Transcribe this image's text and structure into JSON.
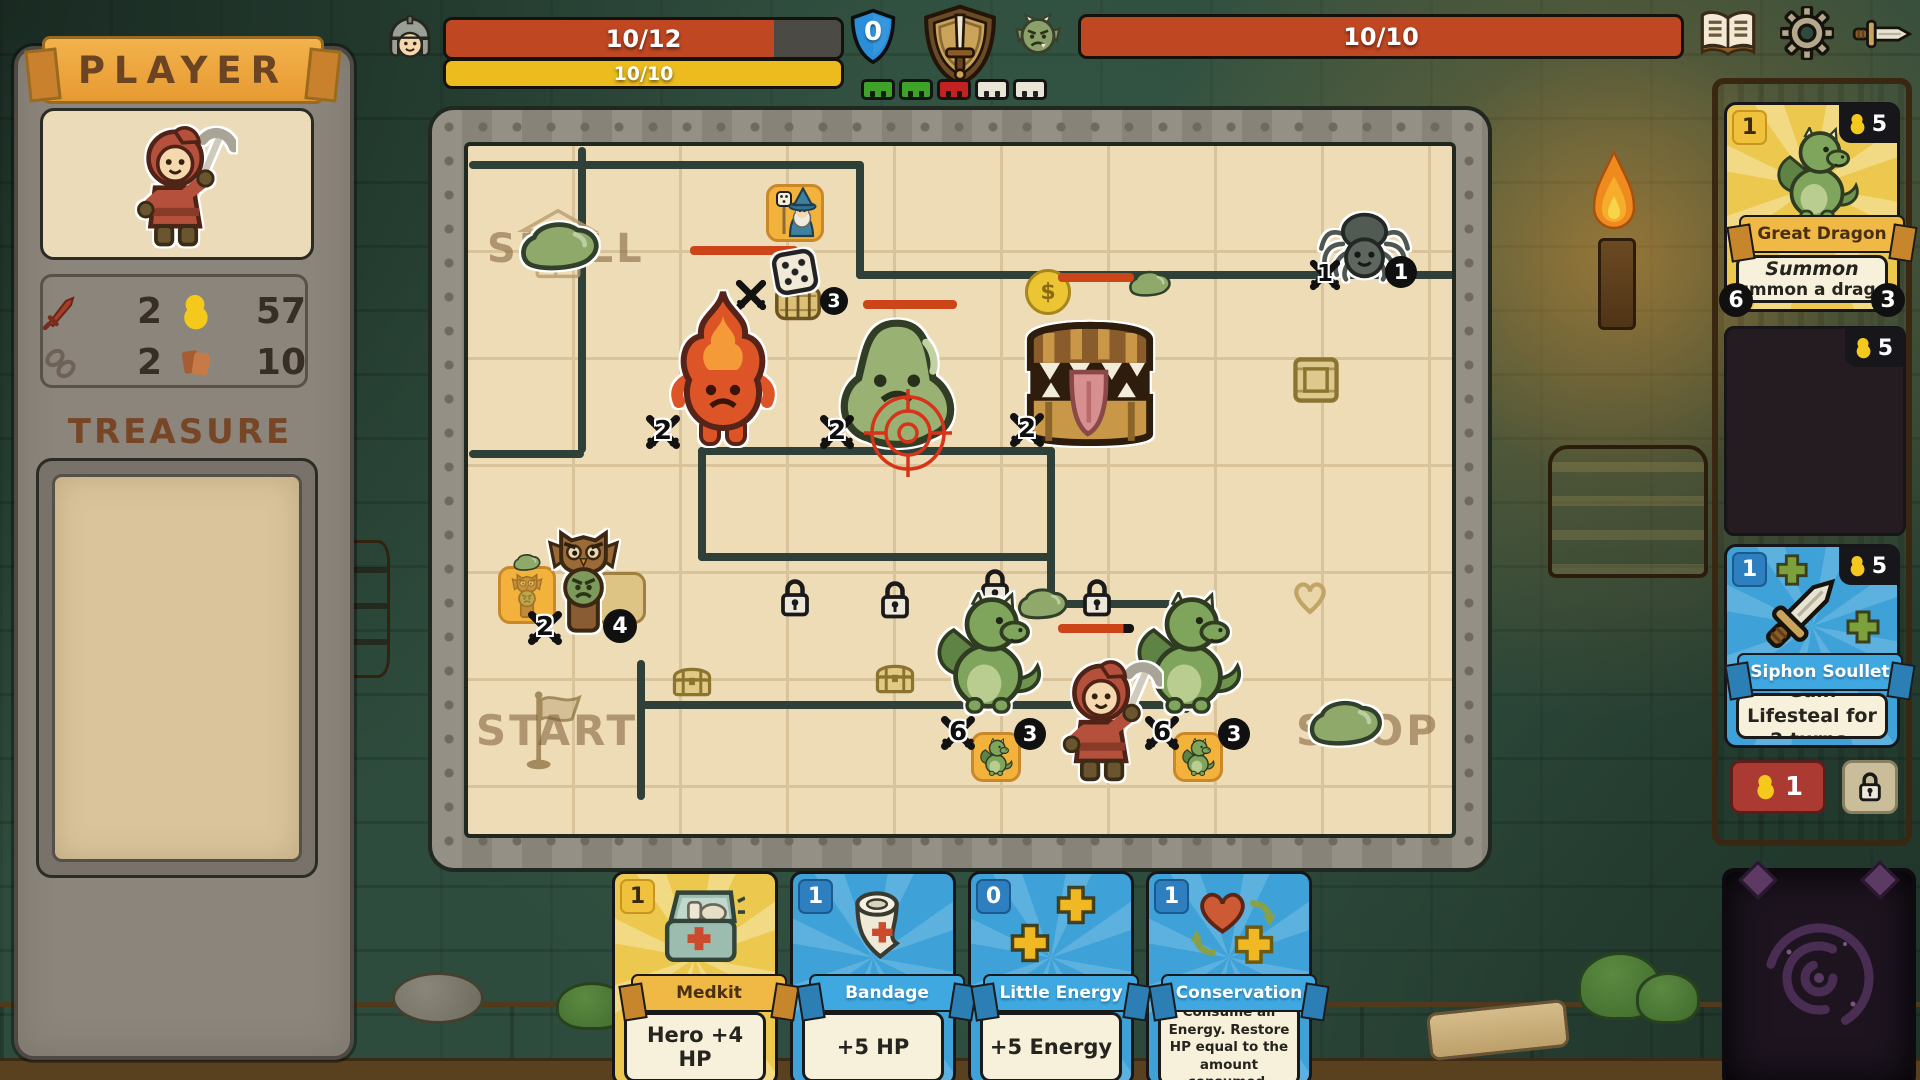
{
  "top": {
    "player_hp": "10/12",
    "player_energy": "10/10",
    "block": "0",
    "enemy_hp": "10/10",
    "turn_segments": [
      "green",
      "green",
      "red",
      "empty",
      "empty"
    ]
  },
  "left": {
    "title": "PLAYER",
    "stats": {
      "attack": "2",
      "gold": "57",
      "chain": "2",
      "cards": "10"
    },
    "treasure_title": "TREASURE"
  },
  "board": {
    "skull_label": "SKULL",
    "start_label": "START",
    "shop_label": "SHOP",
    "barrel_count": "3",
    "fire_atk": "2",
    "slime_atk": "2",
    "mimic_atk": "2",
    "mimic_coin": "$",
    "spider_atk": "1",
    "spider_count": "1",
    "totem_atk": "2",
    "totem_count": "4",
    "dragon_left_atk": "6",
    "dragon_left_count": "3",
    "dragon_right_atk": "6",
    "dragon_right_count": "3"
  },
  "shop": {
    "cards": [
      {
        "count": "1",
        "cost": "5",
        "name": "Great Dragon",
        "keyword": "Summon",
        "desc": "Summon a dragon",
        "atk": "6",
        "uses": "3"
      },
      {
        "cost": "5"
      },
      {
        "count": "1",
        "cost": "5",
        "name": "Siphon Soullet",
        "desc": "Gain Lifesteal for 2 turns."
      }
    ],
    "reroll_cost": "1"
  },
  "hand": [
    {
      "count": "1",
      "name": "Medkit",
      "desc": "Hero +4 HP"
    },
    {
      "count": "1",
      "name": "Bandage",
      "desc": "+5 HP"
    },
    {
      "count": "0",
      "name": "Little Energy",
      "desc": "+5 Energy"
    },
    {
      "count": "1",
      "name": "Conservation",
      "desc": "Consume all Energy. Restore HP equal to the amount consumed."
    }
  ],
  "icons": {
    "book": "journal-book",
    "gear": "settings-gear",
    "sword": "attack-sword",
    "helmet": "player-helmet",
    "goblin": "enemy-goblin",
    "shield": "block-shield",
    "coin": "gold-coin",
    "lock": "padlock",
    "crossed_swords": "attack-badge"
  },
  "colors": {
    "hp_red": "#bf4722",
    "energy_yellow": "#ecbc1e",
    "block_blue": "#2a8ed8",
    "card_blue": "#3ea2d8",
    "card_yellow": "#ecc94e",
    "banner_orange": "#eda43f"
  }
}
